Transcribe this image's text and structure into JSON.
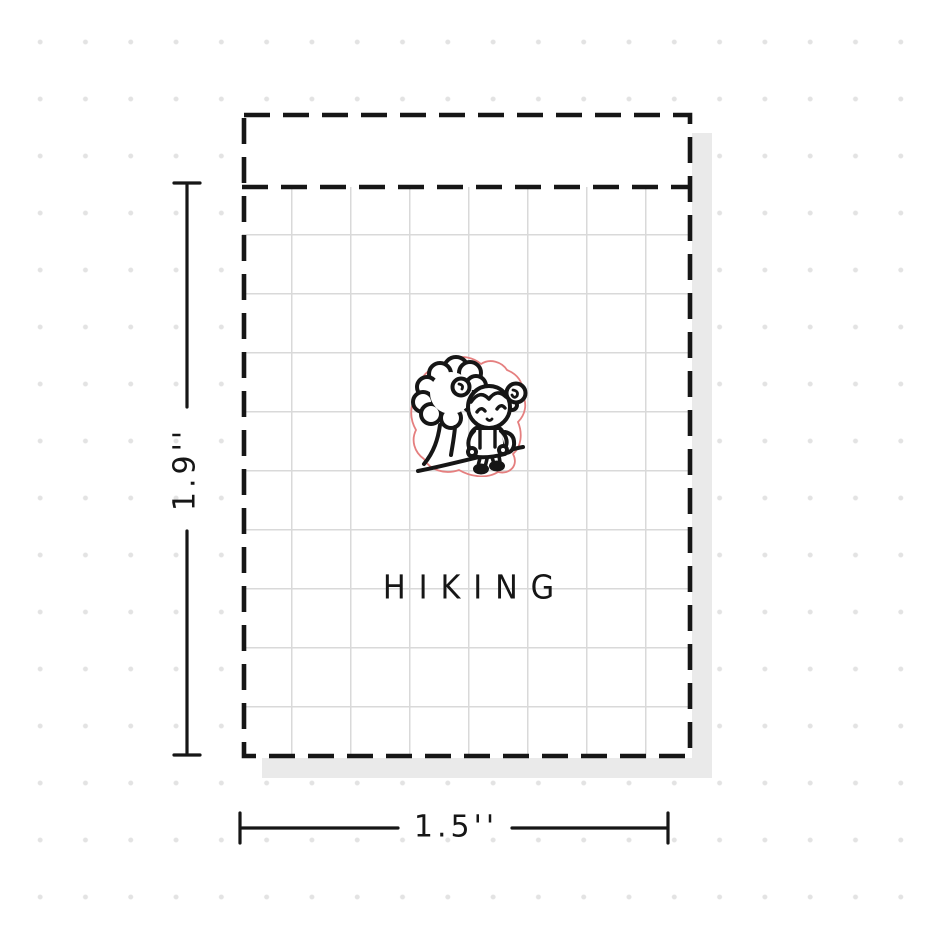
{
  "mockup": {
    "type": "sticker-sheet-dimension-diagram",
    "sticker": {
      "title": "HIKING",
      "illustration": "girl-hiking-with-backpack-next-to-tree",
      "diecut_outline_color": "#e57f7f",
      "line_art_color": "#161616"
    },
    "dimensions": {
      "height_label": "1.9''",
      "width_label": "1.5''"
    },
    "colors": {
      "background": "#ffffff",
      "background_dots": "#e3e3e3",
      "sheet_shadow": "#eaeaea",
      "sheet_grid": "#d9d9d9",
      "cut_line": "#161616"
    },
    "icons": {
      "tree": "tree-icon",
      "hiker": "hiker-girl-icon"
    }
  }
}
